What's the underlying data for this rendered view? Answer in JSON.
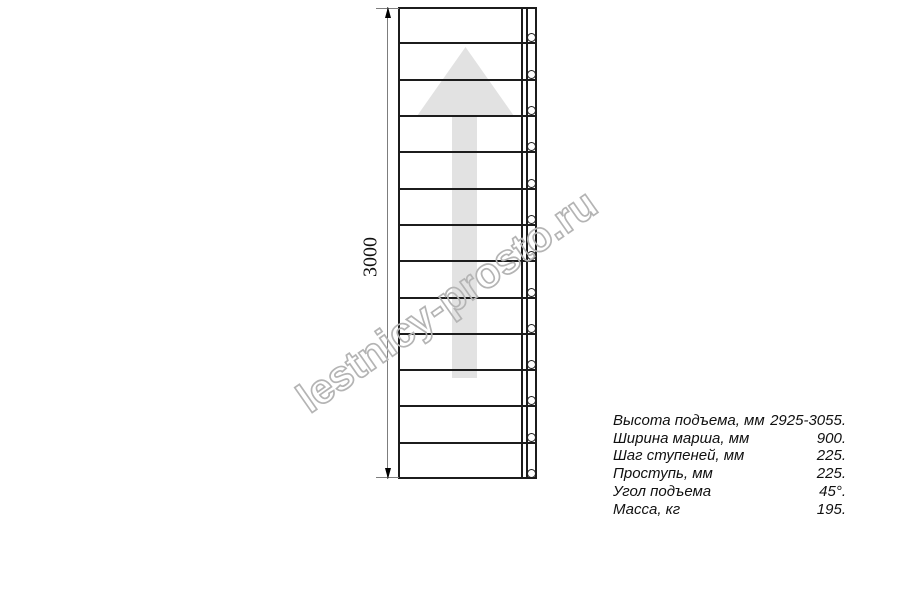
{
  "drawing": {
    "type": "ladder-plan-view",
    "dimension_label": "3000",
    "steps_count": 13,
    "direction": "up",
    "colors": {
      "line": "#1c1c1c",
      "dimension": "#7d7d7d",
      "arrow_fill": "#e2e2e2",
      "watermark_outline": "#b4b4b4"
    }
  },
  "watermark": {
    "text": "lestnicy-prosto.ru"
  },
  "specs": {
    "rows": [
      {
        "label": "Высота подъема, мм",
        "value": "2925-3055."
      },
      {
        "label": "Ширина марша, мм",
        "value": "900."
      },
      {
        "label": "Шаг ступеней, мм",
        "value": "225."
      },
      {
        "label": "Проступь, мм",
        "value": "225."
      },
      {
        "label": "Угол подъема",
        "value": "45°."
      },
      {
        "label": "Масса, кг",
        "value": "195."
      }
    ]
  }
}
